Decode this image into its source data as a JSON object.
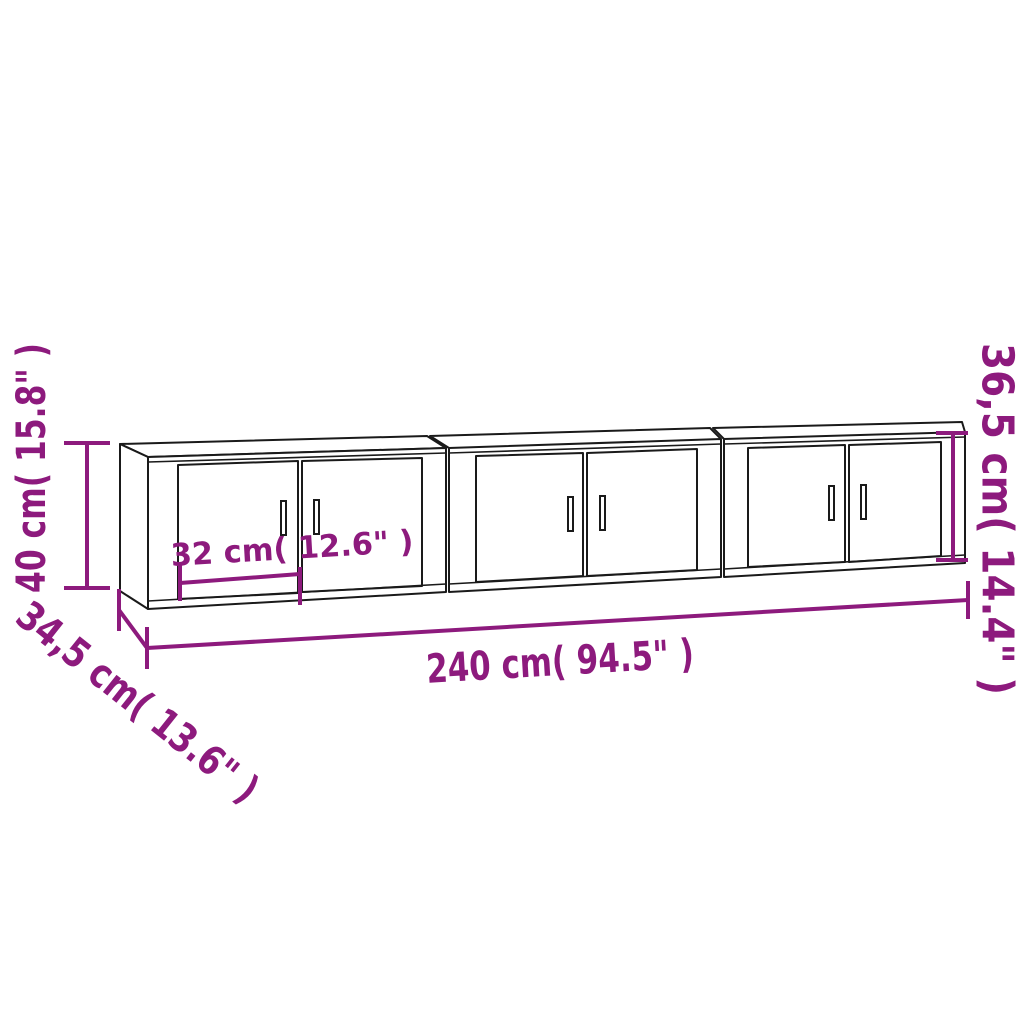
{
  "diagram": {
    "type": "product-dimension-drawing",
    "cabinet_count": 3,
    "colors": {
      "dimension_accent": "#8D1A7D",
      "outline": "#1A1A1A",
      "background": "#FFFFFF"
    },
    "labels": {
      "height": "40 cm( 15.8\" )",
      "depth": "34,5 cm( 13.6\" )",
      "total_width": "240 cm( 94.5\" )",
      "door_width": "32 cm( 12.6\" )",
      "side_height": "36,5 cm( 14.4\" )"
    },
    "values": {
      "height_cm": 40,
      "height_in": 15.8,
      "depth_cm": 34.5,
      "depth_in": 13.6,
      "total_width_cm": 240,
      "total_width_in": 94.5,
      "door_width_cm": 32,
      "door_width_in": 12.6,
      "side_height_cm": 36.5,
      "side_height_in": 14.4
    }
  }
}
